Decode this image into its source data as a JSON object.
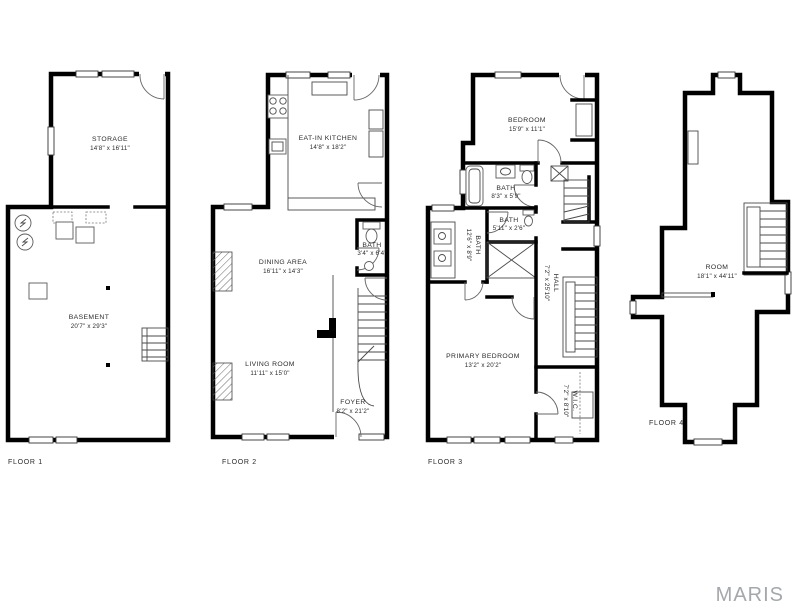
{
  "watermark": "MARIS",
  "colors": {
    "wall": "#000000",
    "label_text": "#2b2b2b",
    "watermark_gray": "#a4a8ac",
    "background": "#ffffff"
  },
  "floors": [
    {
      "label": "FLOOR 1",
      "rooms": [
        {
          "name": "STORAGE",
          "dims": "14'8\" x 16'11\""
        },
        {
          "name": "BASEMENT",
          "dims": "20'7\" x 29'3\""
        }
      ]
    },
    {
      "label": "FLOOR 2",
      "rooms": [
        {
          "name": "EAT-IN KITCHEN",
          "dims": "14'8\" x 18'2\""
        },
        {
          "name": "BATH",
          "dims": "3'4\" x 6'4\""
        },
        {
          "name": "DINING AREA",
          "dims": "16'11\" x 14'3\""
        },
        {
          "name": "LIVING ROOM",
          "dims": "11'11\" x 15'0\""
        },
        {
          "name": "FOYER",
          "dims": "8'2\" x 21'2\""
        }
      ]
    },
    {
      "label": "FLOOR 3",
      "rooms": [
        {
          "name": "BEDROOM",
          "dims": "15'9\" x 11'1\""
        },
        {
          "name": "BATH",
          "dims": "8'3\" x 5'9\""
        },
        {
          "name": "BATH",
          "dims": "5'11\" x 2'6\""
        },
        {
          "name": "BATH",
          "dims": "12'6\" x 8'9\""
        },
        {
          "name": "HALL",
          "dims": "7'2\" x 25'10\""
        },
        {
          "name": "PRIMARY BEDROOM",
          "dims": "13'2\" x 20'2\""
        },
        {
          "name": "W.I.C.",
          "dims": "7'2\" x 8'10\""
        }
      ]
    },
    {
      "label": "FLOOR 4",
      "rooms": [
        {
          "name": "ROOM",
          "dims": "18'1\" x 44'11\""
        }
      ]
    }
  ]
}
